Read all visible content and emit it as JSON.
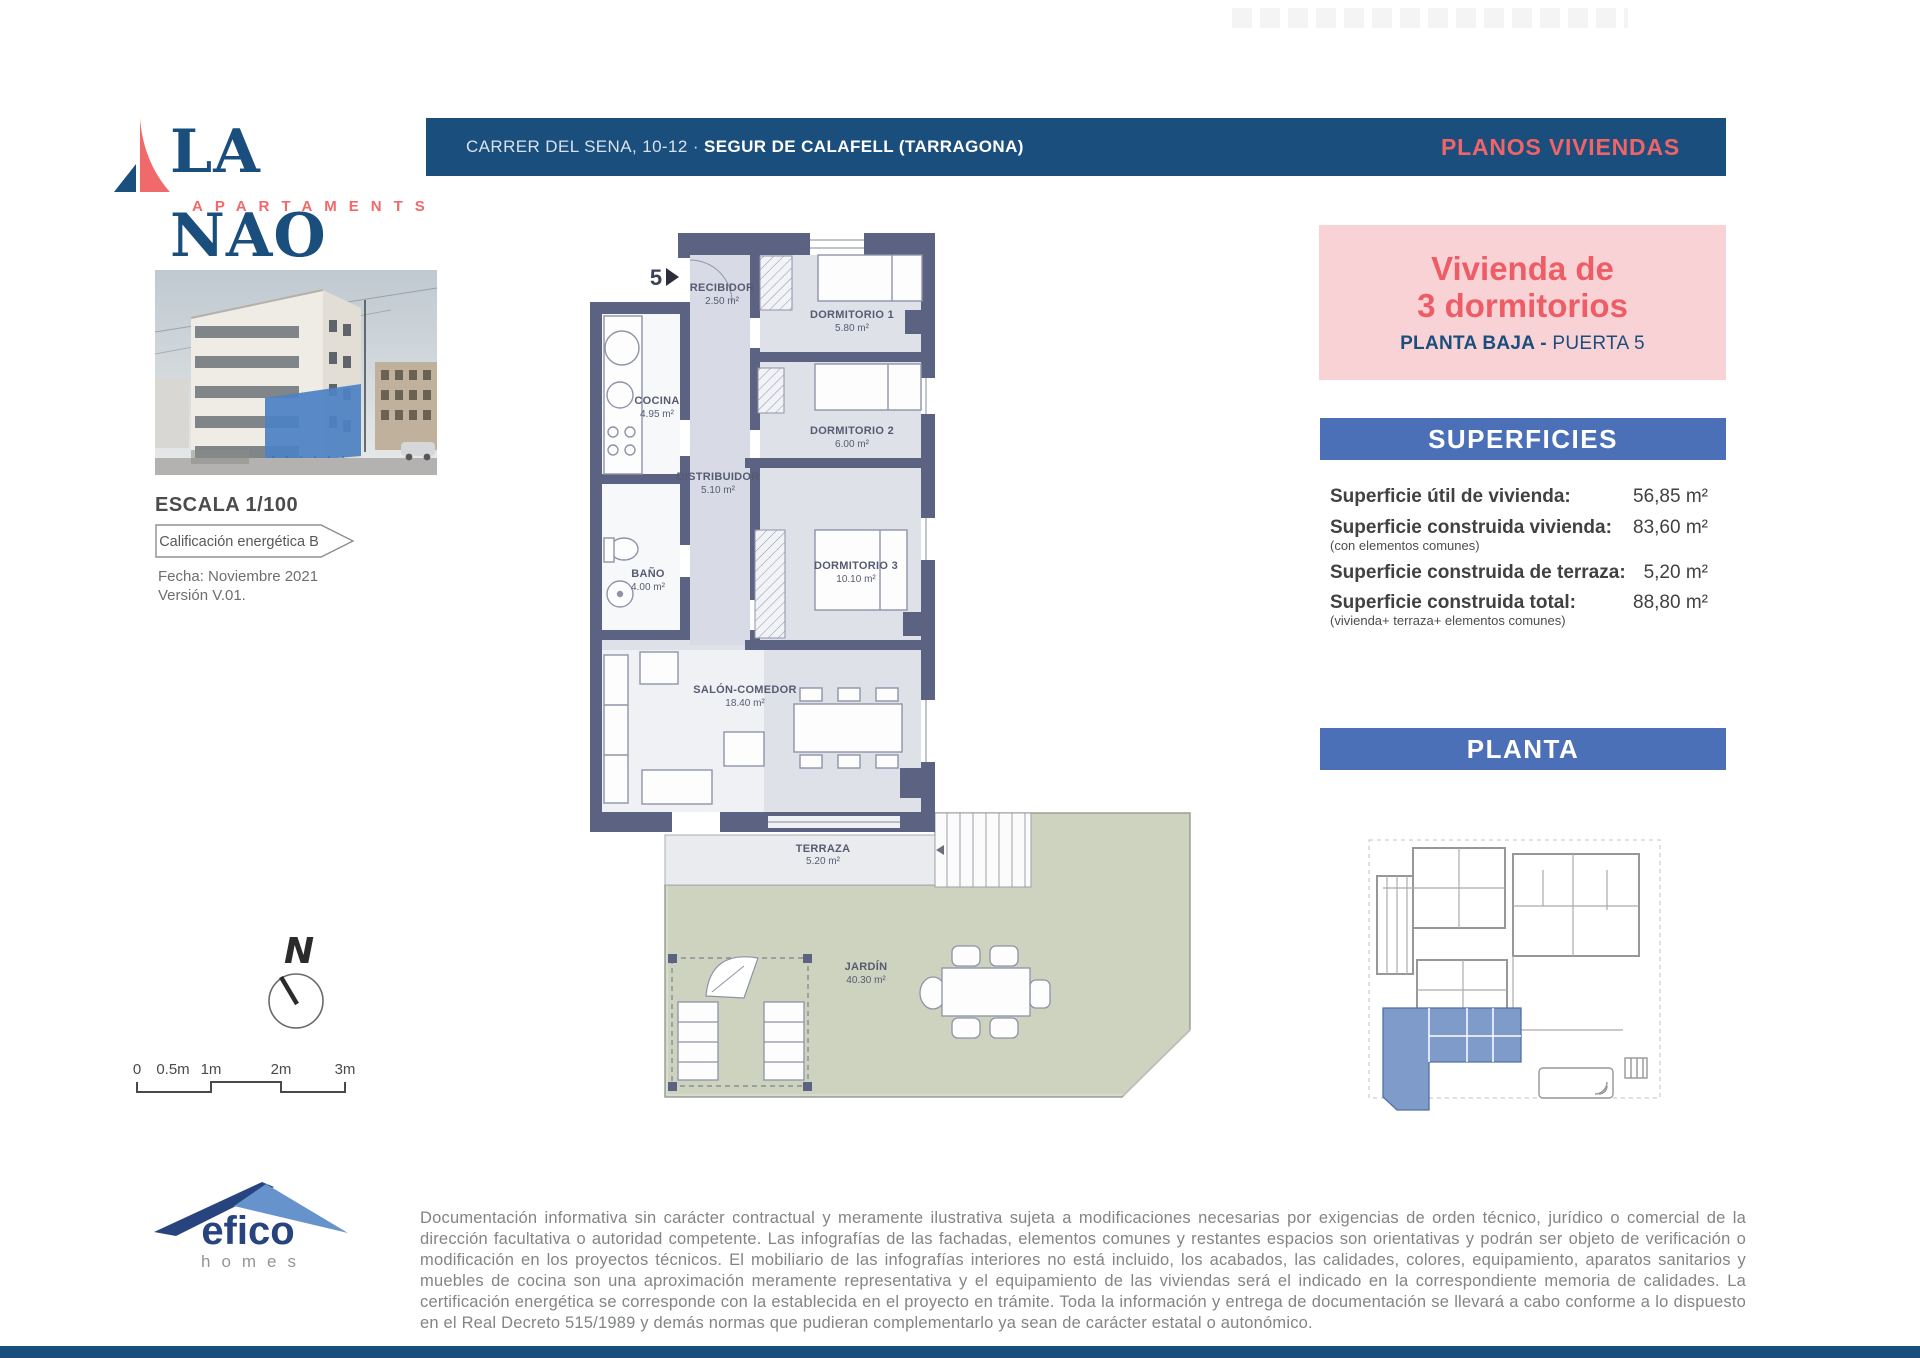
{
  "logo": {
    "name": "LA NAO",
    "subtitle": "APARTAMENTS"
  },
  "header": {
    "address_regular": "CARRER DEL SENA, 10-12",
    "address_separator": " · ",
    "address_bold": "SEGUR DE CALAFELL (TARRAGONA)",
    "right_title": "PLANOS VIVIENDAS"
  },
  "unit": {
    "title_line1": "Vivienda de",
    "title_line2": "3 dormitorios",
    "floor_bold": "PLANTA BAJA - ",
    "floor_regular": "PUERTA 5"
  },
  "superficies": {
    "title": "SUPERFICIES",
    "rows": [
      {
        "label": "Superficie útil de vivienda:",
        "value": "56,85 m²"
      },
      {
        "label": "Superficie construida vivienda:",
        "sublabel": "(con elementos comunes)",
        "value": "83,60 m²"
      },
      {
        "label": "Superficie construida de terraza:",
        "value": "5,20 m²"
      },
      {
        "label": "Superficie construida total:",
        "sublabel": "(vivienda+ terraza+ elementos comunes)",
        "value": "88,80 m²"
      }
    ]
  },
  "planta": {
    "title": "PLANTA"
  },
  "left": {
    "escala": "ESCALA 1/100",
    "energy_badge": "Calificación energética B",
    "fecha": "Fecha: Noviembre 2021",
    "version": "Versión V.01."
  },
  "plan": {
    "door_number": "5",
    "rooms": {
      "recibidor": {
        "name": "RECIBIDOR",
        "area": "2.50 m²"
      },
      "dormitorio1": {
        "name": "DORMITORIO 1",
        "area": "5.80 m²"
      },
      "cocina": {
        "name": "COCINA",
        "area": "4.95 m²"
      },
      "dormitorio2": {
        "name": "DORMITORIO 2",
        "area": "6.00 m²"
      },
      "distribuidor": {
        "name": "DISTRIBUIDOR",
        "area": "5.10 m²"
      },
      "bano": {
        "name": "BAÑO",
        "area": "4.00 m²"
      },
      "dormitorio3": {
        "name": "DORMITORIO 3",
        "area": "10.10 m²"
      },
      "salon": {
        "name": "SALÓN-COMEDOR",
        "area": "18.40 m²"
      },
      "terraza": {
        "name": "TERRAZA",
        "area": "5.20 m²"
      },
      "jardin": {
        "name": "JARDÍN",
        "area": "40.30 m²"
      }
    }
  },
  "compass": {
    "north": "N"
  },
  "scalebar": {
    "labels": [
      "0",
      "0.5m",
      "1m",
      "2m",
      "3m"
    ]
  },
  "footer": {
    "brand": "efico",
    "brand_sub": "homes",
    "disclaimer": "Documentación informativa sin carácter contractual y meramente ilustrativa sujeta a modificaciones necesarias por exigencias de orden técnico, jurídico o comercial de la dirección facultativa o autoridad competente. Las infografías de las fachadas, elementos comunes y restantes espacios son orientativas y podrán ser objeto de verificación o modificación en los proyectos técnicos. El mobiliario de las infografías interiores no está incluido, los acabados, las calidades, colores, equipamiento, aparatos sanitarios y muebles de cocina son una aproximación meramente representativa y el equipamiento de las viviendas será el indicado en la correspondiente memoria de calidades. La certificación energética se corresponde con la establecida en el proyecto en trámite. Toda la información y entrega de documentación se llevará a cabo conforme a lo dispuesto en el Real Decreto 515/1989 y demás normas que pudieran complementarlo ya sean de carácter estatal o autonómico."
  },
  "colors": {
    "navy": "#1a4e7d",
    "coral": "#ef6468",
    "pink": "#f9d2d6",
    "bar_blue": "#4b70b7",
    "wall": "#5c6282",
    "garden": "#cdd3bf",
    "unit_highlight": "#7e9bc9"
  }
}
